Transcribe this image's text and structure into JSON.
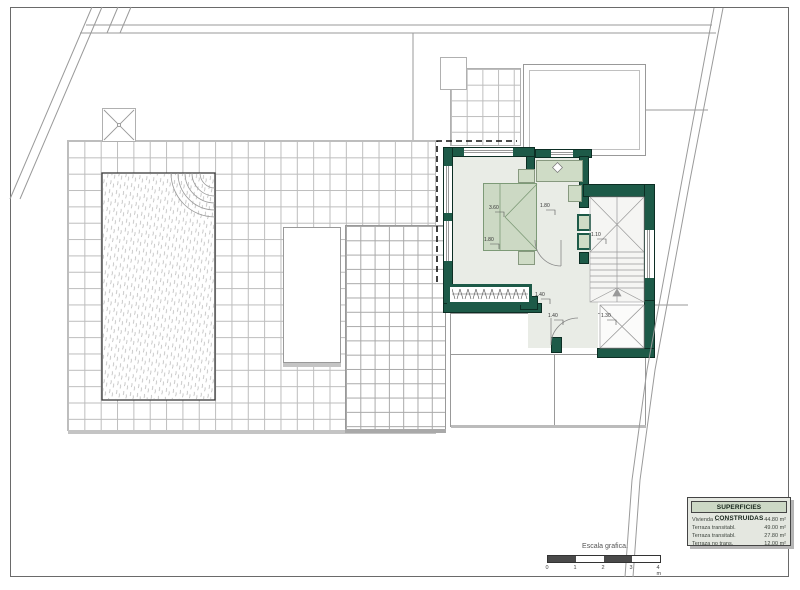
{
  "legend": {
    "title": "SUPERFICIES CONSTRUIDAS",
    "rows": [
      {
        "name": "Vivienda ............",
        "value": "44.80 m²"
      },
      {
        "name": "Terraza transitabl.",
        "value": "49.00 m²"
      },
      {
        "name": "Terraza transitabl.",
        "value": "27.80 m²"
      },
      {
        "name": "Terraza no trans.",
        "value": "12.00 m²"
      }
    ]
  },
  "scale_bar": {
    "label": "Escala grafica.",
    "ticks": [
      "0",
      "1",
      "2",
      "3",
      "4 m"
    ]
  },
  "plan": {
    "dimension_labels": [
      {
        "text": "3.60"
      },
      {
        "text": "1.80"
      },
      {
        "text": "1.80"
      },
      {
        "text": "1.10"
      },
      {
        "text": "1.40"
      },
      {
        "text": "1.40"
      },
      {
        "text": "1.30"
      }
    ],
    "icons": {
      "sink": "diamond",
      "roof_access_marker": "x-cross",
      "skylight": "x-cross",
      "stair_landing": "x-cross"
    }
  },
  "colors": {
    "wall_green": "#1d5a48",
    "interior_floor": "#e9ece6",
    "furniture_sage": "#cfdcc6",
    "legend_header_bg": "#ccd8c5",
    "legend_body_bg": "#e4e7e0",
    "grid_line": "#bdbdbd",
    "scale_dark": "#4a4a4a"
  }
}
